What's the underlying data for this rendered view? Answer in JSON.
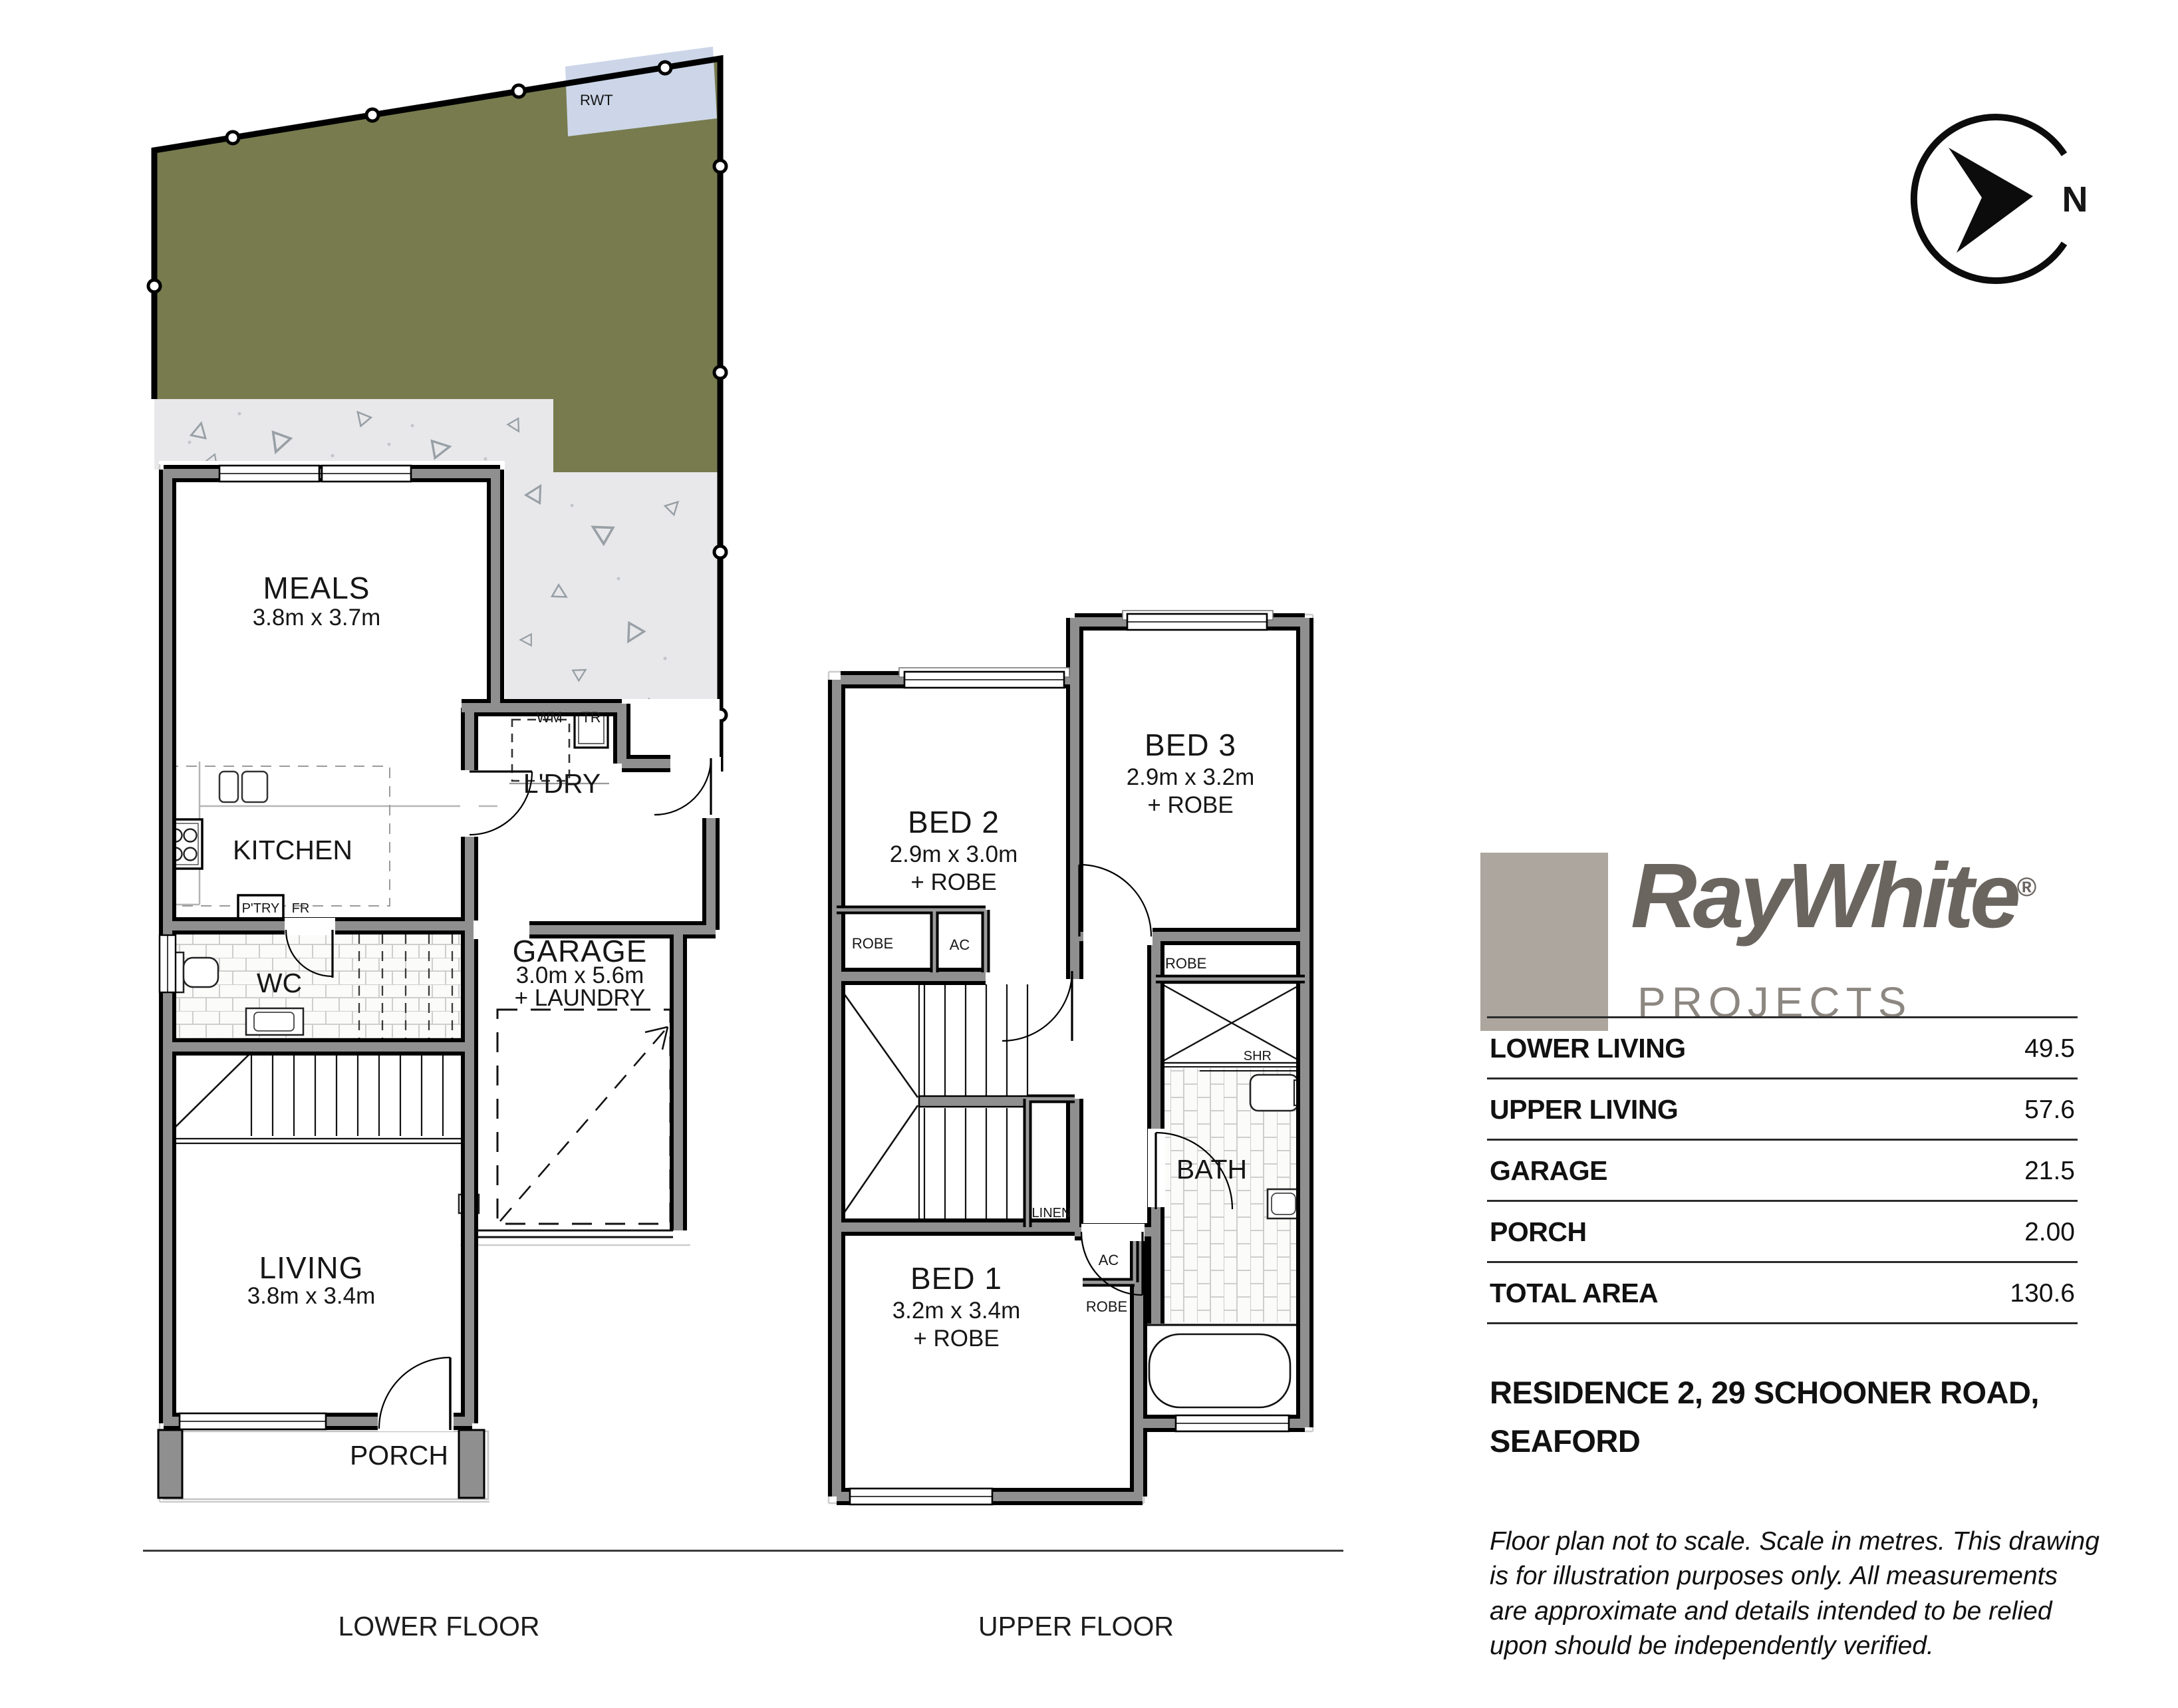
{
  "compass": {
    "north": "N"
  },
  "site": {
    "rwt": "RWT"
  },
  "lower": {
    "label": "LOWER FLOOR",
    "meals_name": "MEALS",
    "meals_dims": "3.8m x 3.7m",
    "kitchen": "KITCHEN",
    "ptry": "P'TRY",
    "fr": "FR",
    "wc": "WC",
    "ldry": "L'DRY",
    "wm": "WM",
    "tr": "TR",
    "garage_name": "GARAGE",
    "garage_dims": "3.0m x 5.6m",
    "garage_extra": "+ LAUNDRY",
    "living_name": "LIVING",
    "living_dims": "3.8m x 3.4m",
    "porch": "PORCH"
  },
  "upper": {
    "label": "UPPER FLOOR",
    "bed1_name": "BED 1",
    "bed1_dims": "3.2m x 3.4m",
    "bed1_extra": "+ ROBE",
    "bed2_name": "BED 2",
    "bed2_dims": "2.9m x 3.0m",
    "bed2_extra": "+ ROBE",
    "bed3_name": "BED 3",
    "bed3_dims": "2.9m x 3.2m",
    "bed3_extra": "+ ROBE",
    "bath": "BATH",
    "shr": "SHR",
    "linen": "LINEN",
    "robe": "ROBE",
    "ac": "AC"
  },
  "brand": {
    "word1": "Ray",
    "word2": "White",
    "reg": "®",
    "sub": "PROJECTS"
  },
  "areas": {
    "rows": [
      {
        "label": "LOWER LIVING",
        "value": "49.5"
      },
      {
        "label": "UPPER LIVING",
        "value": "57.6"
      },
      {
        "label": "GARAGE",
        "value": "21.5"
      },
      {
        "label": "PORCH",
        "value": "2.00"
      },
      {
        "label": "TOTAL AREA",
        "value": "130.6"
      }
    ]
  },
  "address": {
    "line1": "RESIDENCE 2, 29 SCHOONER ROAD,",
    "line2": "SEAFORD"
  },
  "disclaimer": "Floor plan not to scale. Scale in metres. This drawing is for illustration purposes only. All measurements are approximate and details intended to be relied upon should be independently verified.",
  "colors": {
    "yard": "#777b4e",
    "concrete": "#e8e8ea",
    "wall": "#8f8f8f",
    "rwt": "#ccd6e8",
    "brand_dark": "#6b6560",
    "brand_mid": "#8d8781",
    "brand_square": "#aca69e"
  }
}
